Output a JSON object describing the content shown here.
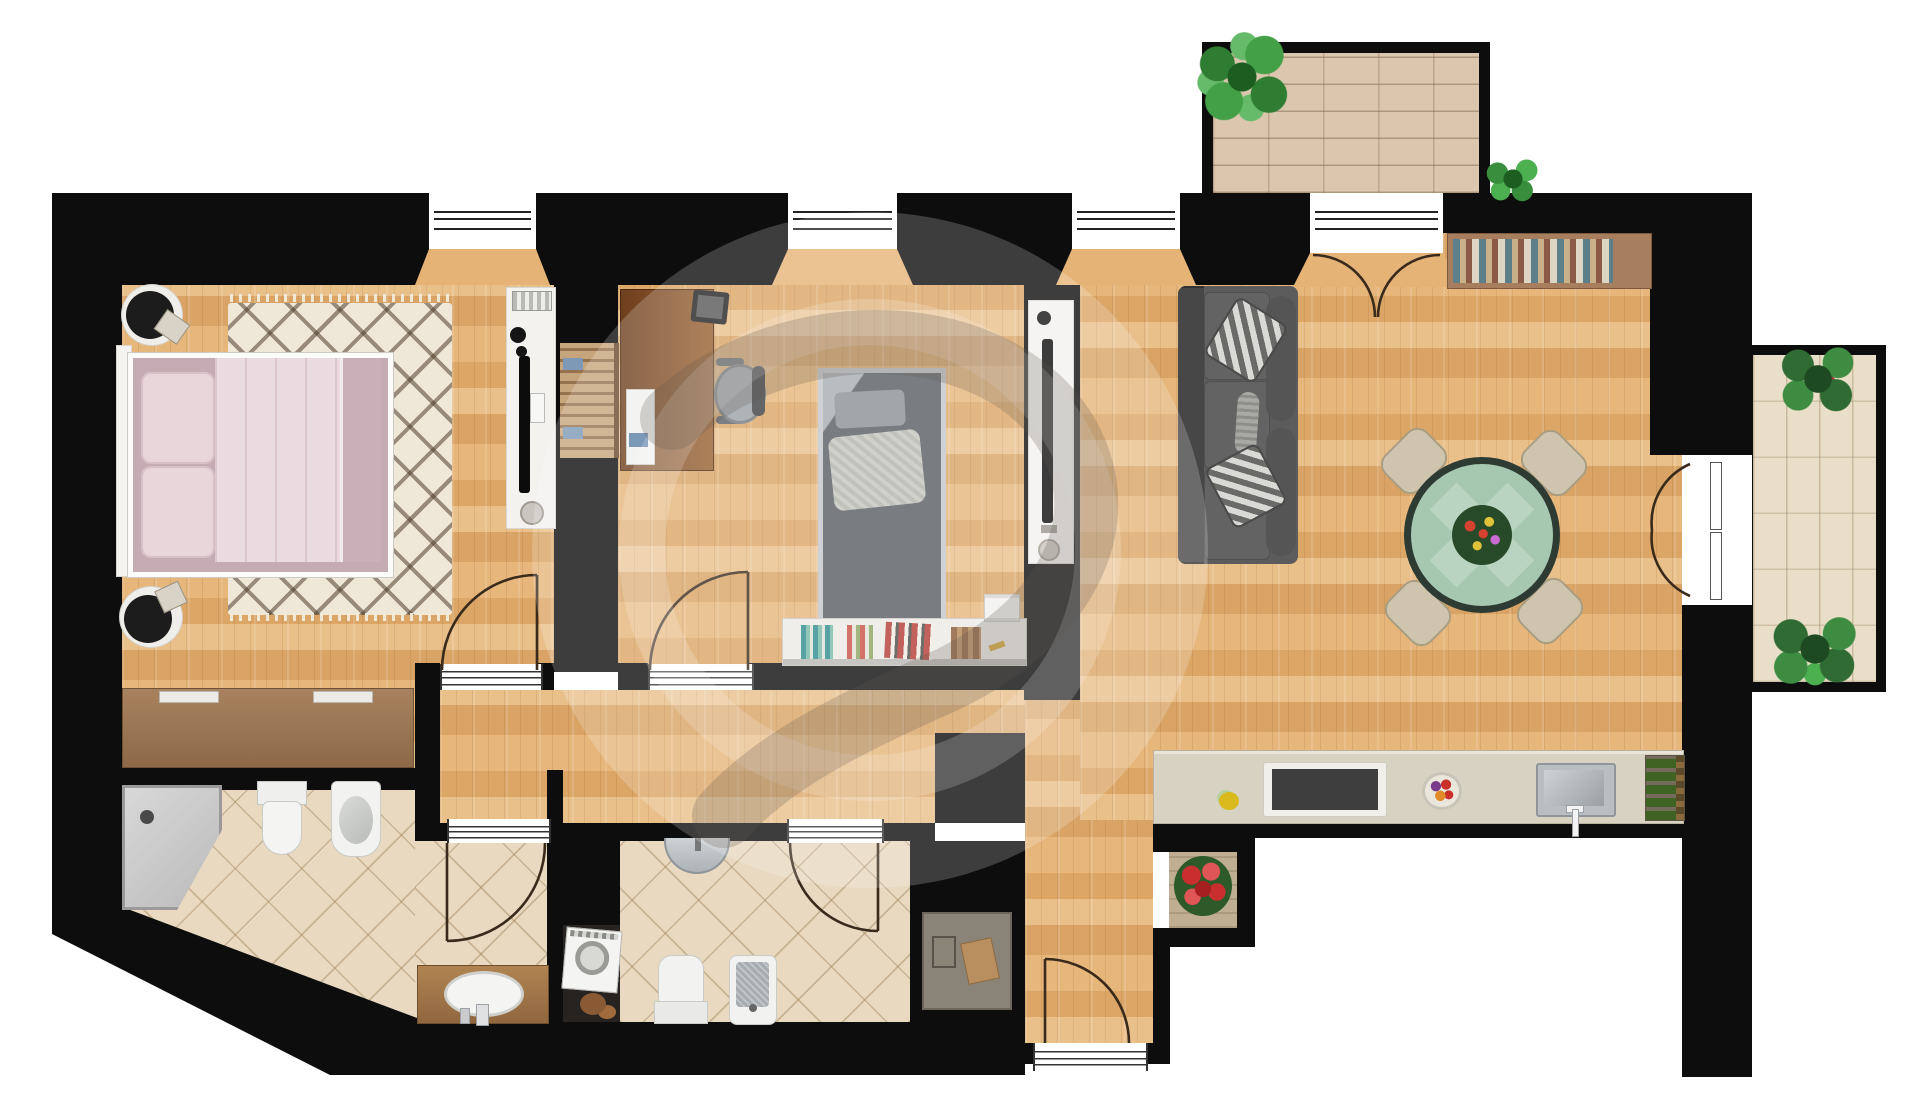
{
  "document": {
    "type": "apartment-floor-plan",
    "style": "photorealistic top-down 2D render",
    "visible_text_labels": [],
    "watermark": {
      "shape": "large translucent circle with curved logo swoosh",
      "position": "center"
    }
  },
  "palette": {
    "wall": "#0d0d0d",
    "wood": "#e2ae6f",
    "tile": "#e8d9c0",
    "brick": "#dbc7ae",
    "btile": "#e9dfc8",
    "counter": "#d8d2c2",
    "exterior": "#ffffff",
    "bed_linen": "#e9dbdf",
    "sofa": "#5c5c5c",
    "dining_table": "#a6c8b0"
  },
  "rooms": [
    {
      "id": "master-bedroom",
      "floor": "wood",
      "furniture": [
        "double-bed",
        "headboard",
        "pillow",
        "pillow",
        "diamond-rug",
        "round-nightstand",
        "round-nightstand",
        "sideboard-dresser",
        "tv-panel",
        "wall-radiator",
        "speaker"
      ]
    },
    {
      "id": "built-in-closet",
      "floor": "none",
      "furniture": [
        "wardrobe-clothes-rail"
      ]
    },
    {
      "id": "bedroom-2",
      "floor": "wood",
      "furniture": [
        "desk",
        "notepad",
        "laptop",
        "office-chair",
        "single-bed",
        "pillow",
        "knit-pillow",
        "bookshelf",
        "books",
        "storage-box"
      ]
    },
    {
      "id": "living-dining-kitchen",
      "floor": "wood",
      "furniture": [
        "tv-panel",
        "sofa",
        "patterned-pillow",
        "patterned-pillow",
        "bolster-pillow",
        "round-dining-table",
        "flower-centerpiece",
        "dining-chair",
        "dining-chair",
        "dining-chair",
        "dining-chair",
        "wall-bookshelf",
        "kitchen-counter",
        "cooktop",
        "kitchen-sink",
        "fruit-bowl",
        "lemon",
        "wine-rack"
      ]
    },
    {
      "id": "hallway",
      "floor": "wood",
      "furniture": [
        "workspace-desk",
        "documents",
        "flower-plant"
      ]
    },
    {
      "id": "bathroom-1",
      "floor": "tile",
      "furniture": [
        "corner-shower",
        "toilet",
        "bidet",
        "wood-vanity",
        "oval-sink"
      ]
    },
    {
      "id": "bathroom-2",
      "floor": "tile",
      "furniture": [
        "half-round-sink",
        "toilet",
        "shower-tray",
        "washing-machine",
        "laundry-basket"
      ]
    },
    {
      "id": "terrace",
      "floor": "brick-paving",
      "furniture": [
        "green-plant",
        "palm-plant"
      ]
    },
    {
      "id": "balcony",
      "floor": "stone-tile",
      "furniture": [
        "flowering-plant",
        "palm-plant"
      ]
    }
  ],
  "openings": {
    "windows": 3,
    "terrace-french-door": 1,
    "balcony-double-door": 1,
    "entrance-door": 1,
    "interior-doors": [
      "master-bedroom-door",
      "bedroom-2-door",
      "bathroom-1-door",
      "bathroom-2-door"
    ]
  }
}
